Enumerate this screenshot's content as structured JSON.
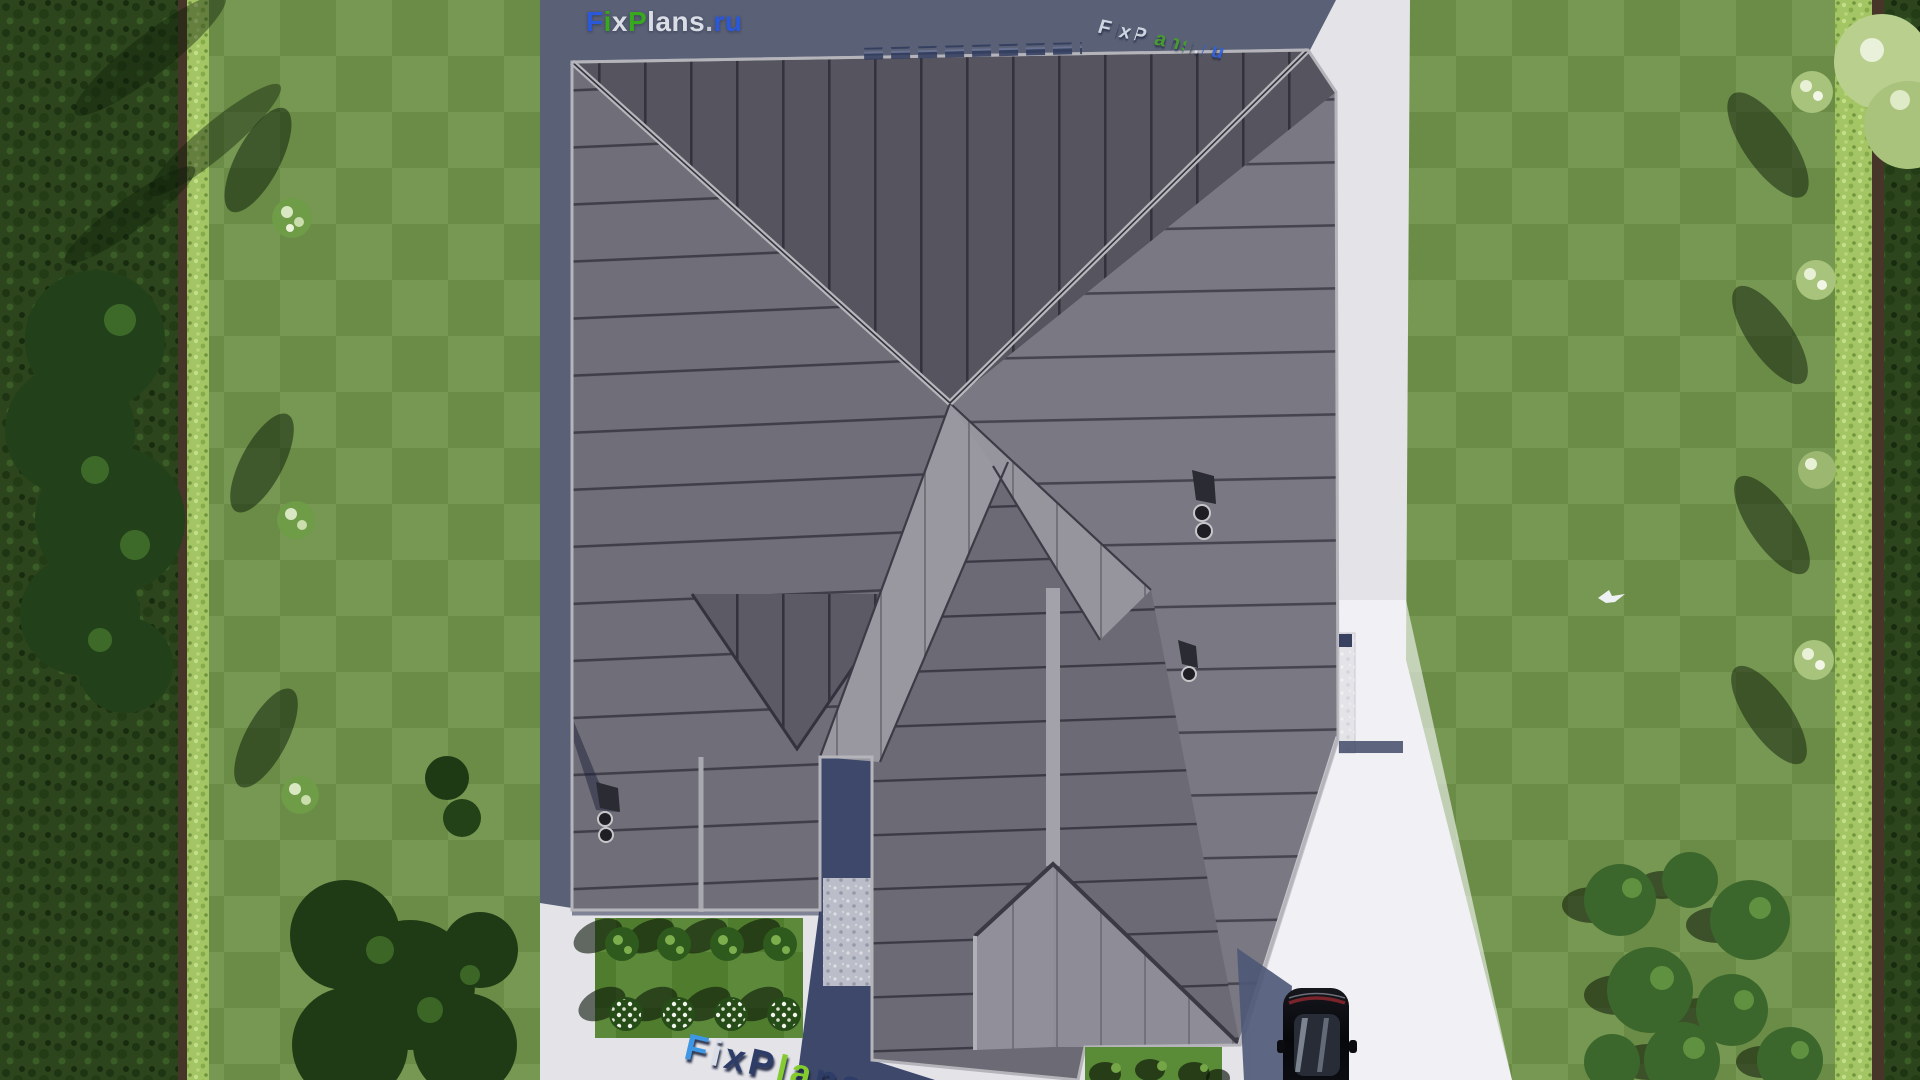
{
  "meta": {
    "description": "Aerial top-down 3D render of a house with dark standing-seam hip roof, paved yard, lawns, hedges and a black car",
    "canvas": {
      "width": 1920,
      "height": 1080
    },
    "site": "FixPlans.ru"
  },
  "watermarks": {
    "top_left": {
      "parts": [
        {
          "t": "F",
          "c": "#2b58d8"
        },
        {
          "t": "i",
          "c": "#38a81f"
        },
        {
          "t": "x",
          "c": "#dadde6"
        },
        {
          "t": "P",
          "c": "#38a81f"
        },
        {
          "t": "lans",
          "c": "#dadde6"
        },
        {
          "t": ".",
          "c": "#c6cad6"
        },
        {
          "t": "ru",
          "c": "#2b58d8"
        }
      ]
    },
    "top_right": {
      "parts": [
        {
          "t": "F",
          "c": "#d9deea"
        },
        {
          "t": "i",
          "c": "#3566e0"
        },
        {
          "t": "x",
          "c": "#d9deea"
        },
        {
          "t": "P",
          "c": "#d9deea"
        },
        {
          "t": "lans",
          "c": "#45a226"
        },
        {
          "t": ".",
          "c": "#d9deea"
        },
        {
          "t": "ru",
          "c": "#2f62de"
        }
      ]
    },
    "bottom": {
      "parts": [
        {
          "t": "F",
          "c": "#3d97e4"
        },
        {
          "t": "i",
          "c": "#d9dee8"
        },
        {
          "t": "x",
          "c": "#2e3c68"
        },
        {
          "t": "P",
          "c": "#2e3c68"
        },
        {
          "t": "la",
          "c": "#84cb30"
        },
        {
          "t": "ns",
          "c": "#2e3c68"
        },
        {
          "t": ".ru",
          "c": "#2e3c68"
        }
      ]
    }
  },
  "palette": {
    "lawn": "#6f9249",
    "hedge_bright": "#a3c564",
    "outer_vegetation": "#2c451d",
    "pavement": "#e3e3e8",
    "pavement_shadow": "#5a6177",
    "roof_dark": "#56555f",
    "roof_mid": "#706f79",
    "roof_light": "#9998a0",
    "roof_trim": "#b6b6bc",
    "car_body": "#0b0c10",
    "watermark_blue": "#2b58d8",
    "watermark_green": "#38a81f"
  },
  "scene": {
    "house": {
      "roof_style": "hip roof, standing-seam metal",
      "chimneys": 3,
      "vent_pipes": 5,
      "wall_niche": 1
    },
    "garden_bed": {
      "shrubs": 4,
      "flower_clusters": 4
    },
    "vehicle": {
      "type": "car",
      "color": "black",
      "position": "driveway bottom right"
    },
    "landscape": {
      "lawns": 2,
      "hedge_rows": 2,
      "pale_trees_left": 3,
      "pale_trees_right": 4,
      "bush_cluster_bottom_right": 8
    },
    "bird": 1
  }
}
